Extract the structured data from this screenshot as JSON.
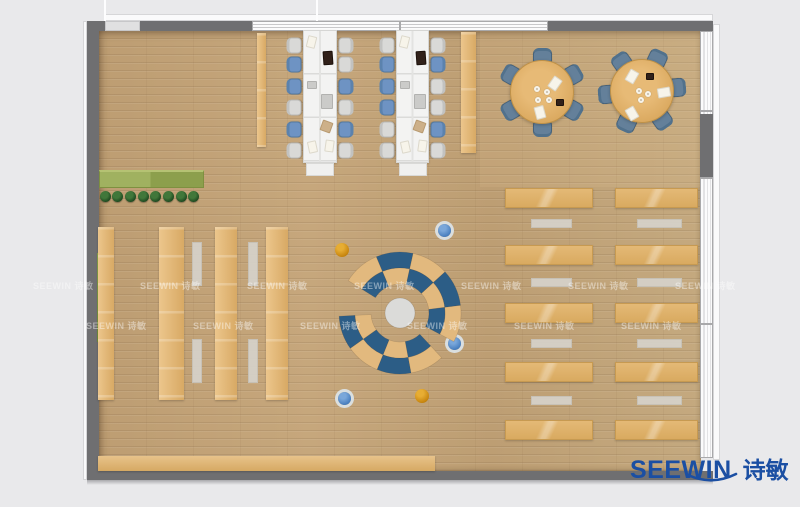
{
  "logo": {
    "brand": "SEEWIN",
    "cn": "诗敏"
  },
  "watermark": {
    "text": "SEEWIN 诗敏",
    "rows": [
      {
        "y": 279,
        "x_start": 33,
        "count": 7,
        "step": 107
      },
      {
        "y": 319,
        "x_start": 86,
        "count": 6,
        "step": 107
      }
    ]
  },
  "palette": {
    "bg": "#e9e9eb",
    "wall": "#6f6f71",
    "wood": "#c0a175",
    "desk-white": "#f3f3f2",
    "chair-gray": "#d9d9d7",
    "chair-blue": "#6e93c3",
    "chair-slate": "#64809a",
    "table-tan": "#dca75e",
    "shelf-tan": "#e0b672",
    "bench-gray": "#d6d2ca",
    "arc-blue": "#2c5d86",
    "arc-tan": "#e2b97e",
    "lounge-center": "#dbdbd9",
    "planter-green": "#95a854",
    "plant-green": "#1d4a20",
    "ball-orange": "#c8860f",
    "ball-blue": "#4e86c6",
    "logo-blue": "#1b4fa3"
  },
  "furniture": {
    "chair_row_ys": [
      45,
      64,
      86,
      107,
      129,
      150
    ],
    "desk_items": [
      {
        "dx": 4,
        "dy": 6,
        "w": 9,
        "h": 12,
        "c": "paper",
        "rot": 14
      },
      {
        "dx": 20,
        "dy": 21,
        "w": 10,
        "h": 14,
        "c": "dark",
        "rot": -4
      },
      {
        "dx": 4,
        "dy": 51,
        "w": 10,
        "h": 8,
        "c": "gray",
        "rot": 0
      },
      {
        "dx": 18,
        "dy": 64,
        "w": 12,
        "h": 15,
        "c": "gray",
        "rot": 0
      },
      {
        "dx": 18,
        "dy": 91,
        "w": 11,
        "h": 11,
        "c": "tanitem",
        "rot": 20
      },
      {
        "dx": 5,
        "dy": 111,
        "w": 9,
        "h": 12,
        "c": "paper",
        "rot": -12
      },
      {
        "dx": 22,
        "dy": 110,
        "w": 9,
        "h": 12,
        "c": "paper",
        "rot": 8
      }
    ],
    "workstation_clusters": [
      {
        "desk": {
          "x": 303,
          "y": 30,
          "w": 34,
          "h": 133
        },
        "cap": {
          "x": 306,
          "y": 163,
          "w": 28,
          "h": 13
        },
        "chairs_left": [
          "gray",
          "blue",
          "blue",
          "gray",
          "blue",
          "gray"
        ],
        "chairs_right": [
          "gray",
          "gray",
          "blue",
          "gray",
          "blue",
          "gray"
        ]
      },
      {
        "desk": {
          "x": 396,
          "y": 30,
          "w": 33,
          "h": 133
        },
        "cap": {
          "x": 399,
          "y": 163,
          "w": 28,
          "h": 13
        },
        "chairs_left": [
          "gray",
          "blue",
          "blue",
          "blue",
          "gray",
          "gray"
        ],
        "chairs_right": [
          "gray",
          "blue",
          "gray",
          "gray",
          "blue",
          "gray"
        ]
      }
    ],
    "round_tables": [
      {
        "cx": 542,
        "cy": 92,
        "r": 32,
        "chair_dist": 36,
        "chair_angle_offset": 30,
        "items": [
          {
            "t": "paper",
            "dx": 13,
            "dy": -9,
            "rot": 35
          },
          {
            "t": "paper",
            "dx": -2,
            "dy": 20,
            "rot": -15
          },
          {
            "t": "dark",
            "dx": 18,
            "dy": 10
          },
          {
            "t": "cup",
            "dx": -5,
            "dy": -3
          },
          {
            "t": "cup",
            "dx": 5,
            "dy": 0
          },
          {
            "t": "cup",
            "dx": -4,
            "dy": 8
          },
          {
            "t": "cup",
            "dx": 7,
            "dy": 8
          }
        ]
      },
      {
        "cx": 642,
        "cy": 91,
        "r": 32,
        "chair_dist": 36,
        "chair_angle_offset": 5,
        "items": [
          {
            "t": "paper",
            "dx": -10,
            "dy": -15,
            "rot": 30
          },
          {
            "t": "paper",
            "dx": 22,
            "dy": 1,
            "rot": 80
          },
          {
            "t": "paper",
            "dx": -10,
            "dy": 22,
            "rot": -30
          },
          {
            "t": "dark",
            "dx": 8,
            "dy": -15
          },
          {
            "t": "cup",
            "dx": -3,
            "dy": 0
          },
          {
            "t": "cup",
            "dx": 6,
            "dy": 3
          },
          {
            "t": "cup",
            "dx": -1,
            "dy": 9
          }
        ]
      }
    ],
    "wall_shelves": [
      {
        "x": 257,
        "y": 33,
        "w": 9,
        "h": 114
      },
      {
        "x": 461,
        "y": 32,
        "w": 15,
        "h": 121
      }
    ],
    "planter": {
      "x": 99,
      "y": 170,
      "w": 105,
      "h": 18,
      "plant_count": 8,
      "plant_x0": 105,
      "plant_step": 12.7,
      "plant_y": 196
    },
    "wall_hedge": {
      "x": 97,
      "y": 253,
      "w": 4,
      "h": 89
    },
    "library": {
      "strips": [
        {
          "x": 98,
          "w": 16
        },
        {
          "x": 159,
          "w": 25
        },
        {
          "x": 215,
          "w": 22
        },
        {
          "x": 266,
          "w": 22
        }
      ],
      "y": 227,
      "h": 173,
      "bench_xs": [
        192,
        248
      ],
      "bench_ys": [
        242,
        339
      ],
      "bench_w": 10,
      "bench_h": 44
    },
    "reading": {
      "cols": [
        {
          "x": 505,
          "w": 88,
          "bx": 531,
          "bw": 41
        },
        {
          "x": 615,
          "w": 83,
          "bx": 637,
          "bw": 45
        }
      ],
      "row_ys": [
        188,
        245,
        303,
        362,
        420
      ],
      "row_h": 20,
      "bench_ys": [
        219,
        278,
        339,
        396
      ],
      "bench_h": 9
    },
    "bottom_bench": {
      "x": 98,
      "y": 456,
      "w": 337,
      "h": 15
    },
    "lounge": {
      "cx": 400,
      "cy": 313,
      "center_r": 15,
      "r0": 29,
      "r1": 45,
      "r2": 61,
      "arcs": [
        {
          "a0": 148,
          "a1": -28,
          "n": 5,
          "outer_first": "tan"
        },
        {
          "a0": 183,
          "a1": 313,
          "n": 4,
          "outer_first": "blue"
        }
      ]
    },
    "beanbags": [
      {
        "x": 342,
        "y": 250,
        "c": "orange"
      },
      {
        "x": 444,
        "y": 230,
        "c": "blue"
      },
      {
        "x": 454,
        "y": 343,
        "c": "blue"
      },
      {
        "x": 422,
        "y": 396,
        "c": "orange"
      },
      {
        "x": 344,
        "y": 398,
        "c": "blue"
      }
    ]
  }
}
